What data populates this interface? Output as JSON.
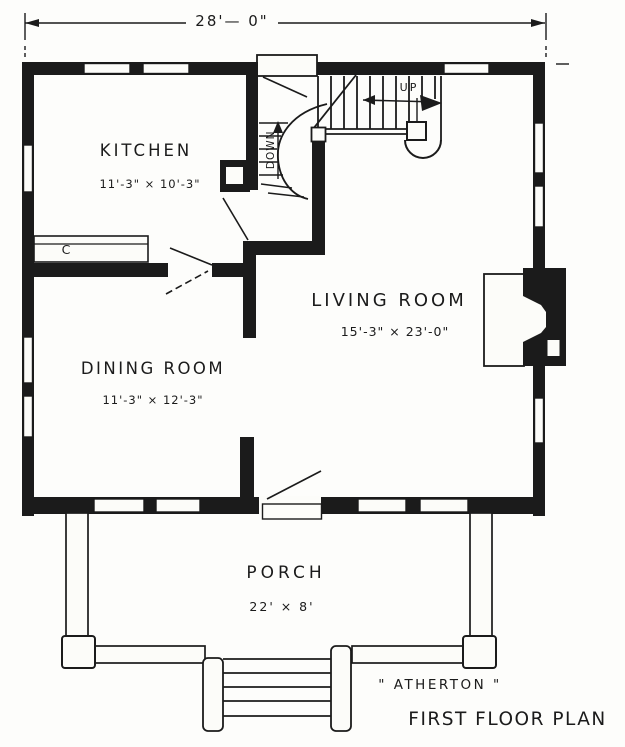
{
  "colors": {
    "ink": "#1b1b1b",
    "paper": "#fcfcf9"
  },
  "dimension": {
    "overall": "28'— 0\""
  },
  "rooms": {
    "kitchen": {
      "name": "KITCHEN",
      "dims": "11'-3\" × 10'-3\""
    },
    "living": {
      "name": "LIVING ROOM",
      "dims": "15'-3\" × 23'-0\""
    },
    "dining": {
      "name": "DINING ROOM",
      "dims": "11'-3\" × 12'-3\""
    },
    "porch": {
      "name": "PORCH",
      "dims": "22' × 8'"
    }
  },
  "stairs": {
    "up": "UP",
    "down": "DOWN"
  },
  "kitchen_counter": {
    "label": "C"
  },
  "titles": {
    "house": "\" ATHERTON \"",
    "plan": "FIRST FLOOR PLAN"
  }
}
